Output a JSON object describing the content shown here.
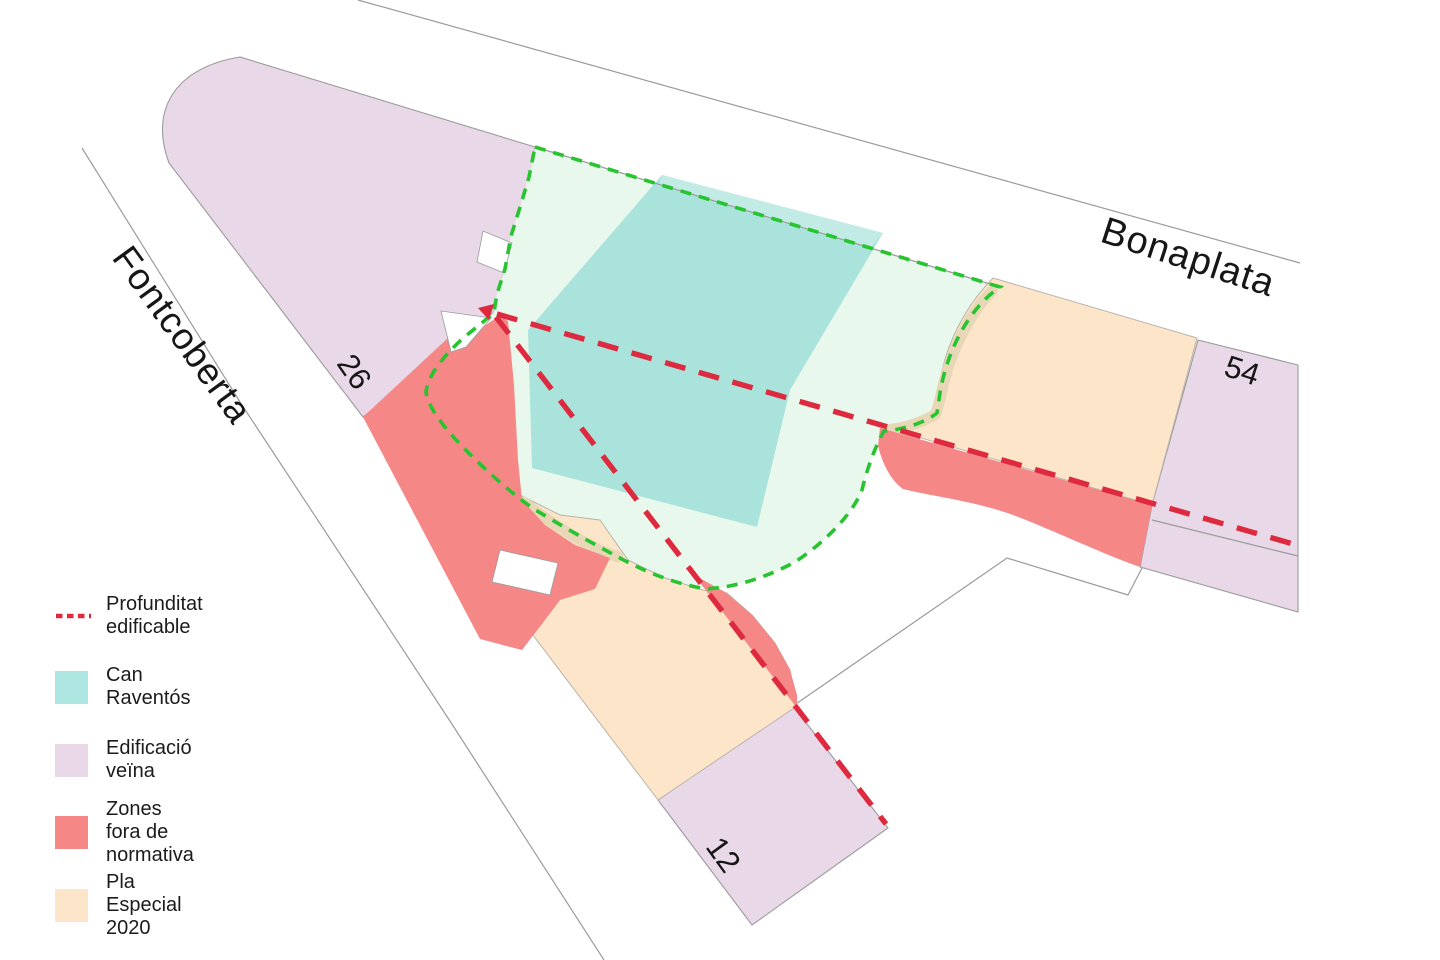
{
  "map": {
    "streets": {
      "fontcoberta": "Fontcoberta",
      "bonaplata": "Bonaplata"
    },
    "parcel_numbers": {
      "fontcoberta_26": "26",
      "bonaplata_54": "54",
      "bonaplata_12": "12"
    }
  },
  "legend": {
    "items": [
      {
        "label": "Profunditat edificable",
        "type": "dashed-line",
        "color": "#dd2a3e"
      },
      {
        "label": "Can Raventós",
        "type": "swatch",
        "color": "#aee7e1"
      },
      {
        "label": "Edificació veïna",
        "type": "swatch",
        "color": "#e9d8e7"
      },
      {
        "label": "Zones fora de normativa",
        "type": "swatch",
        "color": "#f58787"
      },
      {
        "label": "Pla Especial 2020",
        "type": "swatch",
        "color": "#fce5c9"
      }
    ]
  },
  "colors": {
    "can_raventos": "#a9e3dc",
    "edificacio_veina": "#e9d8e7",
    "zones_fora_normativa": "#f58787",
    "pla_especial": "#fce5c9",
    "plot_fill": "#e9f8ec",
    "plot_outline": "#27c42f",
    "profunditat_line": "#dd2a3e",
    "street_line": "#9b9b9b"
  }
}
